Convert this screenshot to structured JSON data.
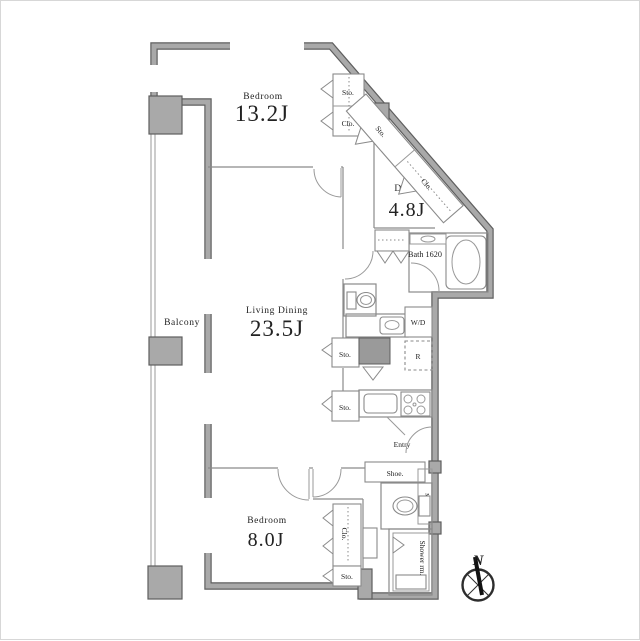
{
  "rooms": {
    "bedroom_main": {
      "name": "Bedroom",
      "size": "13.2J"
    },
    "living_dining": {
      "name": "Living Dining",
      "size": "23.5J"
    },
    "den": {
      "name": "DEN",
      "size": "4.8J"
    },
    "bedroom_second": {
      "name": "Bedroom",
      "size": "8.0J"
    },
    "bath": {
      "name": "Bath 1620"
    },
    "balcony": {
      "name": "Balcony"
    },
    "entry": {
      "name": "Entry"
    },
    "shower_room": {
      "name": "Shower rm."
    }
  },
  "fixtures": {
    "storage": "Sto.",
    "closet": "Clo.",
    "washer_dryer": "W/D",
    "refrigerator": "R",
    "shoe_cabinet": "Shoe.",
    "meter_box": "MB"
  },
  "compass": {
    "north": "N"
  },
  "colors": {
    "wall_fill": "#a9a9a9",
    "wall_edge": "#5e5e5e",
    "line": "#8a8a8a",
    "text": "#222222",
    "background": "#ffffff"
  }
}
